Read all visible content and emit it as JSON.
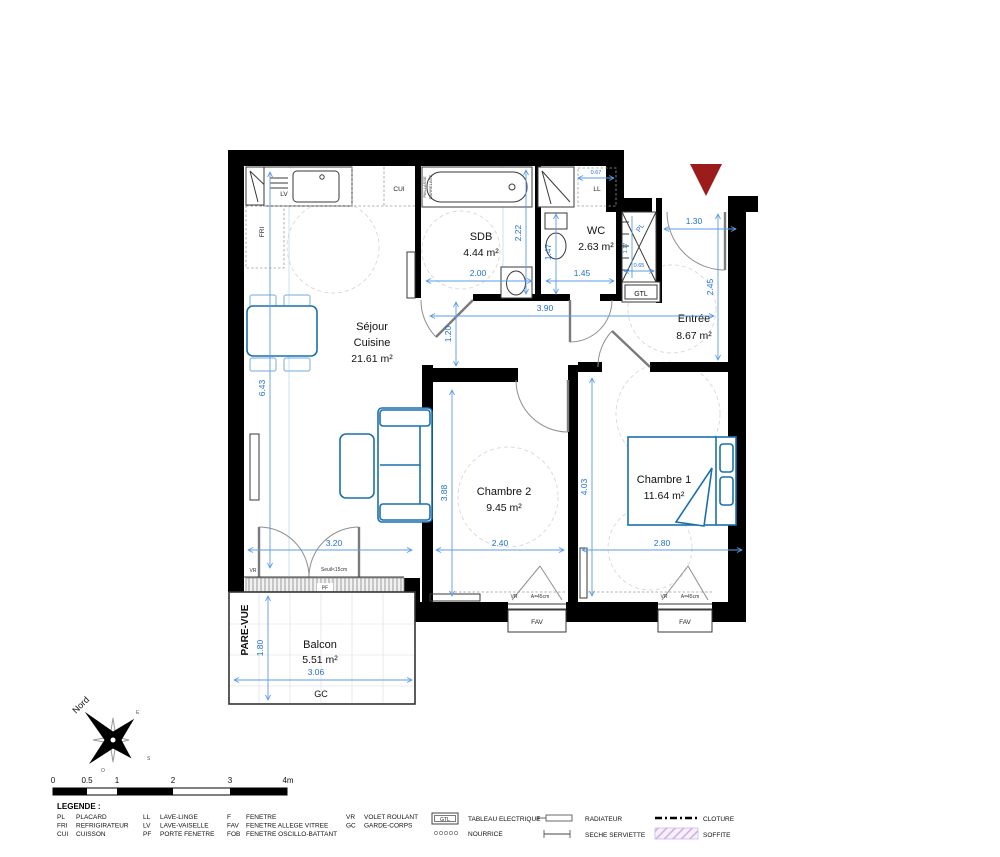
{
  "rooms": {
    "sejour": {
      "line1": "Séjour",
      "line2": "Cuisine",
      "area": "21.61 m²"
    },
    "sdb": {
      "name": "SDB",
      "area": "4.44 m²"
    },
    "wc": {
      "name": "WC",
      "area": "2.63 m²"
    },
    "entree": {
      "name": "Entrée",
      "area": "8.67 m²"
    },
    "chambre2": {
      "name": "Chambre 2",
      "area": "9.45 m²"
    },
    "chambre1": {
      "name": "Chambre 1",
      "area": "11.64 m²"
    },
    "balcon": {
      "name": "Balcon",
      "area": "5.51 m²"
    }
  },
  "dimensions": {
    "sejour_height": "6.43",
    "sejour_door": "3.20",
    "chambre2_height": "3.88",
    "chambre2_width": "2.40",
    "chambre1_height": "4.03",
    "chambre1_width": "2.80",
    "hall_width": "3.90",
    "hall_passage": "1.20",
    "sdb_width": "2.00",
    "sdb_depth": "2.22",
    "wc_width": "1.45",
    "wc_depth": "1.47",
    "ll_width": "0.67",
    "entree_door": "1.30",
    "entree_depth": "2.45",
    "pl_depth": "1.17",
    "pl_width": "0.65",
    "balcon_depth": "1.80",
    "balcon_width": "3.06"
  },
  "fixture_labels": {
    "lv": "LV",
    "cui": "CUI",
    "fri": "FRI",
    "ll": "LL",
    "pl": "PL",
    "gtl": "GTL",
    "pf": "PF",
    "gc": "GC",
    "vr": "VR",
    "fav": "FAV",
    "shutter_width": "A=45cm",
    "seuil": "Seuil<15cm",
    "pare_vue": "PARE-VUE",
    "paillasse": "PAILLASSE",
    "carrelage": "CARRELAGE"
  },
  "compass": {
    "north": "Nord",
    "east": "E",
    "south": "S",
    "west": "O"
  },
  "scale_bar": {
    "ticks": [
      "0",
      "0.5",
      "1",
      "2",
      "3",
      "4m"
    ]
  },
  "legend": {
    "title": "LEGENDE :",
    "abbreviations": [
      {
        "abbr": "PL",
        "label": "PLACARD"
      },
      {
        "abbr": "FRI",
        "label": "REFRIGIRATEUR"
      },
      {
        "abbr": "CUI",
        "label": "CUISSON"
      },
      {
        "abbr": "LL",
        "label": "LAVE-LINGE"
      },
      {
        "abbr": "LV",
        "label": "LAVE-VAISELLE"
      },
      {
        "abbr": "PF",
        "label": "PORTE FENETRE"
      },
      {
        "abbr": "F",
        "label": "FENETRE"
      },
      {
        "abbr": "FAV",
        "label": "FENETRE ALLEGE VITREE"
      },
      {
        "abbr": "FOB",
        "label": "FENETRE OSCILLO-BATTANT"
      },
      {
        "abbr": "VR",
        "label": "VOLET ROULANT"
      },
      {
        "abbr": "GC",
        "label": "GARDE-CORPS"
      }
    ],
    "symbols": [
      {
        "symbol": "GTL",
        "label": "TABLEAU ELECTRIQUE"
      },
      {
        "label": "NOURRICE"
      },
      {
        "label": "RADIATEUR"
      },
      {
        "label": "SECHE SERVIETTE"
      },
      {
        "label": "CLOTURE"
      },
      {
        "label": "SOFFITE"
      }
    ]
  },
  "colors": {
    "wall": "#000000",
    "dimension": "#2170D8",
    "furniture": "#1C6FAE",
    "entrance_marker": "#9C1C1C",
    "soffite": "#D8C7EE"
  }
}
